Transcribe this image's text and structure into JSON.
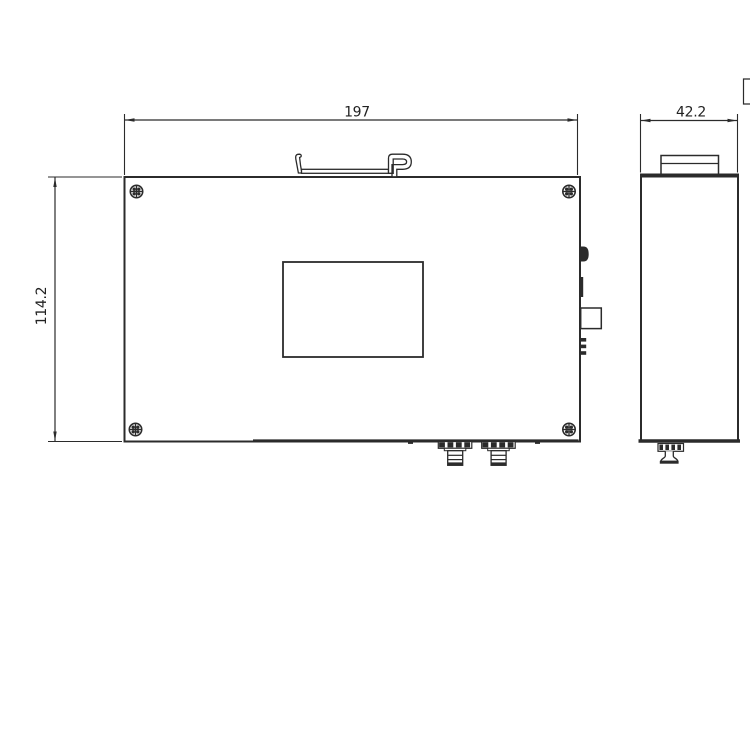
{
  "document": {
    "kind": "mechanical-dimension-drawing",
    "background_color": "#ffffff",
    "line_color": "#2b2b2b",
    "views": {
      "front": {
        "name": "front-view",
        "feature_icons": [
          "din-rail-clip-icon",
          "phillips-screw-icon",
          "label-window",
          "push-button-icon",
          "slot-icon",
          "square-connector-icon",
          "terminal-fins-icon",
          "fiber-connector-icon"
        ]
      },
      "side": {
        "name": "side-view",
        "feature_icons": [
          "din-rail-bracket-icon",
          "release-pin-icon"
        ]
      }
    },
    "dimensions": {
      "width": {
        "value": "197",
        "orientation": "horizontal"
      },
      "height": {
        "value": "114.2",
        "orientation": "vertical"
      },
      "depth": {
        "value": "42.2",
        "orientation": "horizontal"
      }
    }
  }
}
